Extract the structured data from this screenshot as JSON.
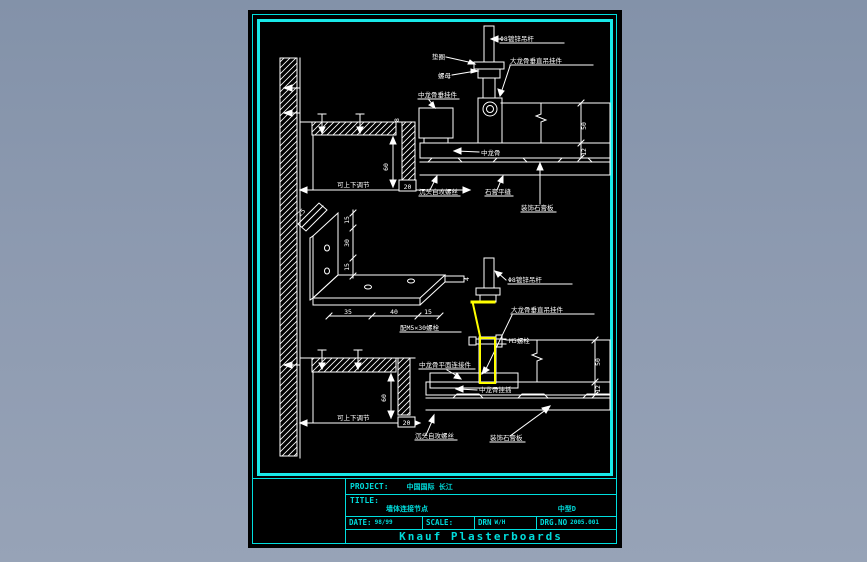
{
  "colors": {
    "frame_cyan": "#19e8e8",
    "text_cyan": "#00dcdc",
    "line_white": "#ffffff",
    "highlight_yellow": "#ffff00",
    "sheet_black": "#000000",
    "background_blue_gray": "#8d9ab0"
  },
  "title_block": {
    "project_label": "PROJECT:",
    "project_value": "中国国际 长江",
    "title_label": "TITLE:",
    "title_value": "墙体连接节点",
    "title_code": "中型D",
    "date_label": "DATE:",
    "date_value": "98/99",
    "scale_label": "SCALE:",
    "scale_value": "",
    "drn_label": "DRN",
    "drn_value": "W/H",
    "drgno_label": "DRG.NO",
    "drgno_value": "2005.001",
    "company": "Knauf Plasterboards"
  },
  "upper": {
    "labels": {
      "rod": "Φ8镀锌吊杆",
      "big_hanger": "大龙骨垂直吊挂件",
      "washer": "垫圈",
      "nut": "螺母",
      "mid_hanger": "中龙骨垂挂件",
      "mid_runner": "中龙骨",
      "screw": "沉头自攻螺丝",
      "joint": "石膏平缝",
      "board": "装饰石膏板",
      "adjust": "可上下调节"
    },
    "dims": {
      "d60": "60",
      "d20": "20",
      "d8": "8",
      "d50": "50",
      "d12": "12"
    }
  },
  "bracket": {
    "dims": {
      "v1": "15",
      "v2": "30",
      "v3": "15",
      "b1": "35",
      "b2": "40",
      "b3": "15",
      "tab": "4",
      "flange": "25"
    },
    "note": "配M5×30螺栓"
  },
  "lower": {
    "labels": {
      "rod": "Φ8镀锌吊杆",
      "big_hanger": "大龙骨垂直吊挂件",
      "bolt": "M5螺栓",
      "flat_connector": "中龙骨平面连接件",
      "runner_insert": "中龙骨挂插",
      "screw": "沉头自攻螺丝",
      "board": "装饰石膏板",
      "adjust": "可上下调节"
    },
    "dims": {
      "d60": "60",
      "d20": "20",
      "d50": "50",
      "d12": "12"
    }
  }
}
